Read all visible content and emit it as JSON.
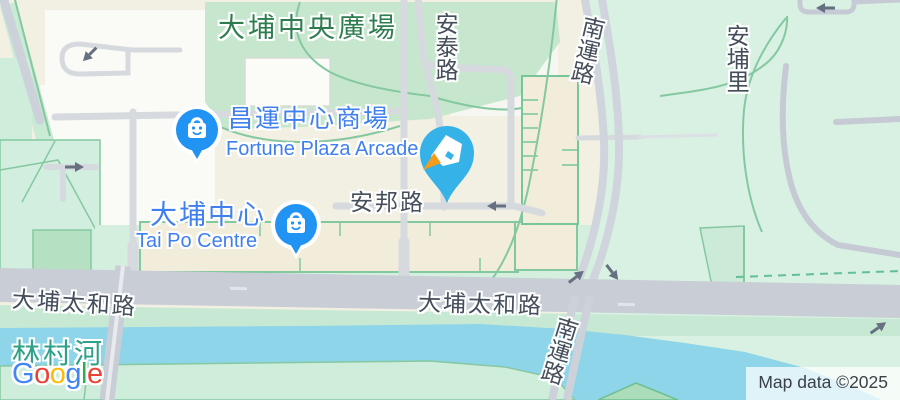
{
  "labels": {
    "central_plaza": "大埔中央廣場",
    "on_tai_road": "安泰路",
    "nam_wan_road_top": "南運路",
    "on_po_lane": "安埔里",
    "fortune_plaza_zh": "昌運中心商場",
    "fortune_plaza_en": "Fortune Plaza Arcade",
    "on_pong_road": "安邦路",
    "tai_po_centre_zh": "大埔中心",
    "tai_po_centre_en": "Tai Po Centre",
    "tai_po_tai_wo_road_west": "大埔太和路",
    "tai_po_tai_wo_road_mid": "大埔太和路",
    "lam_tsuen_river": "林村河",
    "nam_wan_road_bottom": "南運路"
  },
  "markers": {
    "fortune_plaza": {
      "icon": "shopping-bag-pin",
      "color": "#2193F3"
    },
    "tai_po_centre": {
      "icon": "shopping-bag-pin",
      "color": "#2193F3"
    },
    "selected_place": {
      "icon": "pen-nib-pin",
      "color": "#35B2E8",
      "nib_tip_color": "#F49D1C"
    }
  },
  "attribution": {
    "text": "Map data ©2025"
  },
  "logo": {
    "letters": [
      "G",
      "o",
      "o",
      "g",
      "l",
      "e"
    ],
    "colors": [
      "#4285F4",
      "#EA4335",
      "#FBBC05",
      "#4285F4",
      "#34A853",
      "#EA4335"
    ]
  },
  "colors": {
    "urban_block": "#F2EFE3",
    "park_green": "#C6E7CE",
    "mint_green": "#D9F1E3",
    "water": "#8ED5E9",
    "road_major": "#C8CDD6",
    "road_minor": "#D6DADF",
    "street_label": "#454E5B",
    "area_label": "#2E7D4E",
    "poi_label": "#4080EE",
    "river_label": "#2EA189"
  }
}
